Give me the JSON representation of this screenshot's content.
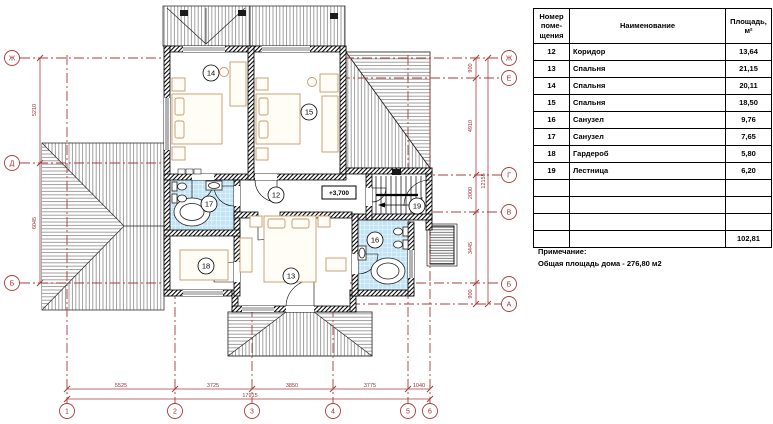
{
  "plan": {
    "level_mark": "+3,700",
    "room_labels": {
      "r12": "12",
      "r13": "13",
      "r14": "14",
      "r15": "15",
      "r16": "16",
      "r17": "17",
      "r18": "18",
      "r19": "19"
    },
    "axes": {
      "left": [
        "Ж",
        "Д",
        "Б"
      ],
      "right": [
        "Ж",
        "Е",
        "Г",
        "В",
        "Б",
        "А"
      ],
      "bottom": [
        "1",
        "2",
        "3",
        "4",
        "5",
        "6"
      ]
    },
    "dims": {
      "bottom": [
        "5525",
        "3725",
        "3850",
        "3775",
        "1040"
      ],
      "bottom_total": "17915",
      "left": [
        "5210",
        "6045"
      ],
      "right": [
        "900",
        "4910",
        "2000",
        "3445",
        "900"
      ],
      "right_total": "12155"
    }
  },
  "table": {
    "header": {
      "num_l1": "Номер",
      "num_l2": "поме-",
      "num_l3": "щения",
      "name": "Наименование",
      "area_l1": "Площадь,",
      "area_l2": "м²"
    },
    "rows": [
      {
        "num": "12",
        "name": "Коридор",
        "area": "13,64"
      },
      {
        "num": "13",
        "name": "Спальня",
        "area": "21,15"
      },
      {
        "num": "14",
        "name": "Спальня",
        "area": "20,11"
      },
      {
        "num": "15",
        "name": "Спальня",
        "area": "18,50"
      },
      {
        "num": "16",
        "name": "Санузел",
        "area": "9,76"
      },
      {
        "num": "17",
        "name": "Санузел",
        "area": "7,65"
      },
      {
        "num": "18",
        "name": "Гардероб",
        "area": "5,80"
      },
      {
        "num": "19",
        "name": "Лестница",
        "area": "6,20"
      },
      {
        "num": "",
        "name": "",
        "area": ""
      },
      {
        "num": "",
        "name": "",
        "area": ""
      },
      {
        "num": "",
        "name": "",
        "area": ""
      }
    ],
    "total_area": "102,81"
  },
  "note": {
    "line1": "Примечание:",
    "line2": "Общая площадь дома  -  276,80 м2"
  },
  "colors": {
    "axis_red": "#a63c3c",
    "tile_blue": "#c2e4f5",
    "furniture_tan": "#c59a6a"
  }
}
